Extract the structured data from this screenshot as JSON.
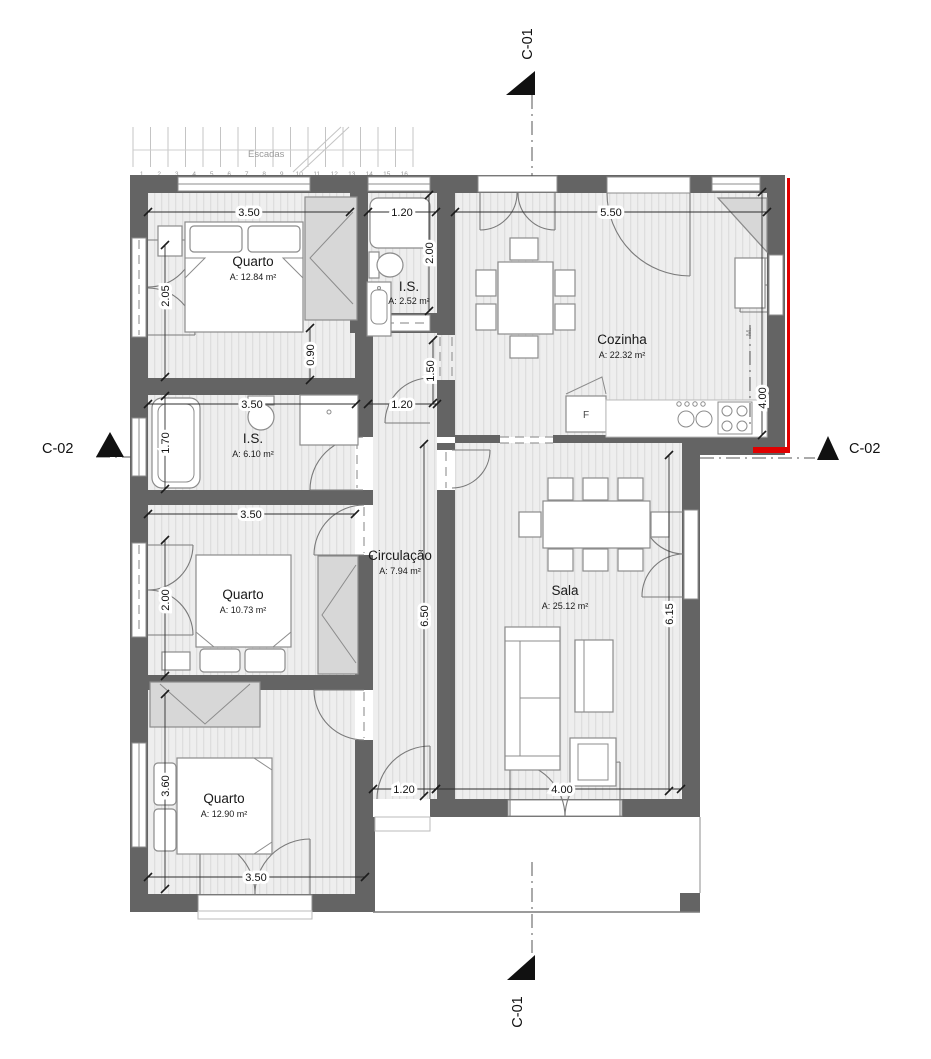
{
  "colors": {
    "wall": "#646464",
    "floor": "#eeeeee",
    "floor_stripe": "#dedede",
    "furniture_stroke": "#8c8c8c",
    "wardrobe_fill": "#d7d7d7",
    "dimension_text": "#111111",
    "section_marker": "#111111",
    "accent_red": "#e00000",
    "stairs": "#c4c4c4"
  },
  "stairs": {
    "label": "Escadas",
    "treads": [
      "1",
      "2",
      "3",
      "4",
      "5",
      "6",
      "7",
      "8",
      "9",
      "10",
      "11",
      "12",
      "13",
      "14",
      "15",
      "16"
    ]
  },
  "rooms": {
    "quarto1": {
      "name": "Quarto",
      "area": "A: 12.84 m²"
    },
    "is_small": {
      "name": "I.S.",
      "area": "A: 2.52 m²"
    },
    "cozinha": {
      "name": "Cozinha",
      "area": "A: 22.32 m²"
    },
    "is_main": {
      "name": "I.S.",
      "area": "A: 6.10 m²"
    },
    "quarto2": {
      "name": "Quarto",
      "area": "A: 10.73 m²"
    },
    "circulacao": {
      "name": "Circulação",
      "area": "A: 7.94 m²"
    },
    "sala": {
      "name": "Sala",
      "area": "A: 25.12 m²"
    },
    "quarto3": {
      "name": "Quarto",
      "area": "A: 12.90 m²"
    }
  },
  "appliances": {
    "fridge": "F",
    "machine": "M."
  },
  "dims": {
    "quarto1_width": "3.50",
    "is2_width": "1.20",
    "cozinha_width": "5.50",
    "is2_depth": "2.00",
    "quarto1_window": "2.05",
    "cozinha_depth": "4.00",
    "nook": "0.90",
    "hall_depth": "1.50",
    "hall_width": "1.20",
    "is1_width": "3.50",
    "is1_tub": "1.70",
    "quarto2_width": "3.50",
    "quarto2_window": "2.00",
    "circulacao_length": "6.50",
    "sala_depth": "6.15",
    "quarto3_depth": "3.60",
    "exit_width": "1.20",
    "sala_width": "4.00",
    "quarto3_width": "3.50"
  },
  "sections": {
    "c01_top": "C-01",
    "c01_bottom": "C-01",
    "c02_left": "C-02",
    "c02_right": "C-02"
  }
}
